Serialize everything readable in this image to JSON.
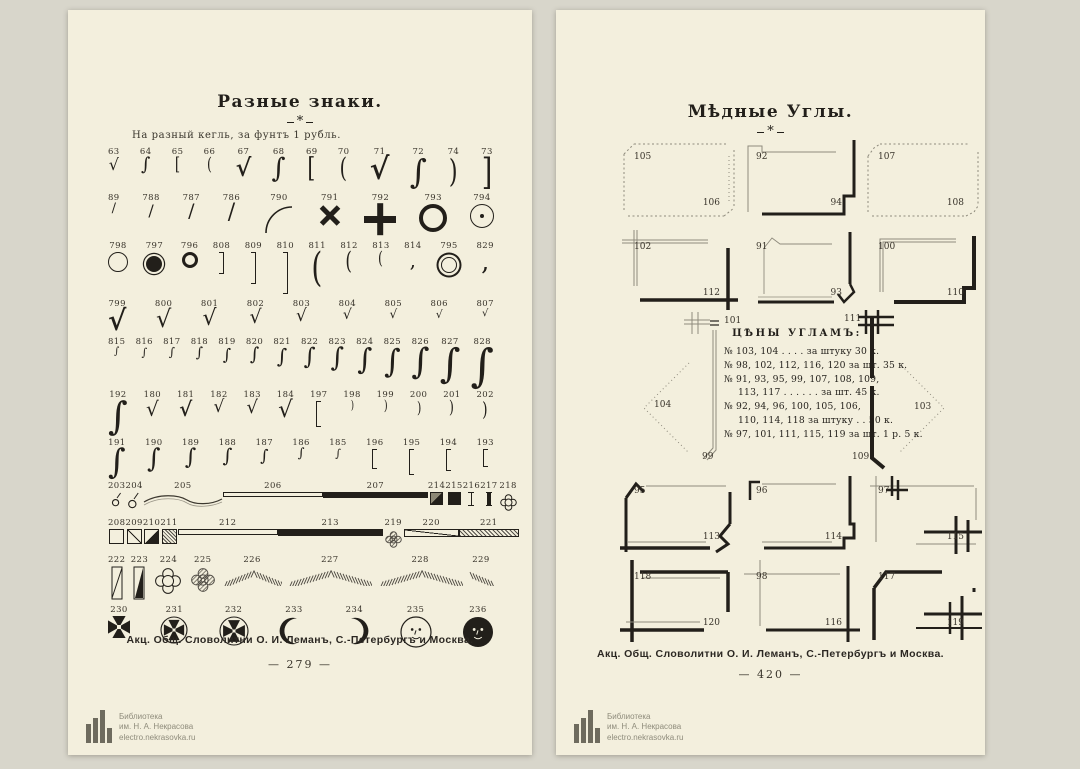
{
  "colors": {
    "backdrop": "#d8d6cb",
    "paper": "#f3efdd",
    "ink": "#221f1a",
    "gray_line": "#9b9789",
    "number": "#39342b"
  },
  "watermark": {
    "library": "Библиотека",
    "name": "им. Н. А. Некрасова",
    "url": "electro.nekrasovka.ru"
  },
  "left_page": {
    "title": "Разные знаки.",
    "ornament": "*",
    "subtitle": "На разный кегль, за фунтъ 1 рубль.",
    "caption": "Акц. Общ. Словолитни О. И. Леманъ, С.-Петербургъ и Москва.",
    "page_number": "— 279 —",
    "rows": [
      {
        "items": [
          {
            "n": "63",
            "g": "rad",
            "s": 16
          },
          {
            "n": "64",
            "g": "int",
            "s": 18
          },
          {
            "n": "65",
            "g": "bro",
            "s": 18
          },
          {
            "n": "66",
            "g": "pao",
            "s": 18
          },
          {
            "n": "67",
            "g": "rad",
            "s": 24,
            "b": 1
          },
          {
            "n": "68",
            "g": "int",
            "s": 27
          },
          {
            "n": "69",
            "g": "bro",
            "s": 27
          },
          {
            "n": "70",
            "g": "pao",
            "s": 27
          },
          {
            "n": "71",
            "g": "rad",
            "s": 30,
            "b": 1
          },
          {
            "n": "72",
            "g": "int",
            "s": 33
          },
          {
            "n": "74",
            "g": "pac",
            "s": 32
          },
          {
            "n": "73",
            "g": "brc",
            "s": 36
          }
        ]
      },
      {
        "items": [
          {
            "n": "89",
            "g": "sl",
            "s": 13
          },
          {
            "n": "788",
            "g": "sl",
            "s": 16
          },
          {
            "n": "787",
            "g": "sl",
            "s": 19
          },
          {
            "n": "786",
            "g": "sl",
            "s": 22
          },
          {
            "n": "790",
            "g": "arc",
            "s": 32
          },
          {
            "n": "791",
            "g": "x",
            "s": 24
          },
          {
            "n": "792",
            "g": "plus",
            "s": 32
          },
          {
            "n": "793",
            "g": "ring",
            "d": 28,
            "bw": 4
          },
          {
            "n": "794",
            "g": "ringdot",
            "d": 24
          }
        ]
      },
      {
        "items": [
          {
            "n": "798",
            "g": "ring",
            "d": 20,
            "bw": 1.2
          },
          {
            "n": "797",
            "g": "ringfill",
            "d": 16
          },
          {
            "n": "796",
            "g": "ring",
            "d": 16,
            "bw": 3.5
          },
          {
            "n": "808",
            "g": "brR",
            "h": 22
          },
          {
            "n": "809",
            "g": "brR",
            "h": 32
          },
          {
            "n": "810",
            "g": "brR",
            "h": 42
          },
          {
            "n": "811",
            "g": "pao",
            "s": 40
          },
          {
            "n": "812",
            "g": "pao",
            "s": 24
          },
          {
            "n": "813",
            "g": "pao",
            "s": 18
          },
          {
            "n": "814",
            "g": "comma",
            "s": 20
          },
          {
            "n": "795",
            "g": "dring",
            "d": 16
          },
          {
            "n": "829",
            "g": "comma",
            "s": 26
          }
        ]
      },
      {
        "items": [
          {
            "n": "799",
            "g": "chk",
            "s": 28,
            "b": 1
          },
          {
            "n": "800",
            "g": "chk",
            "s": 24
          },
          {
            "n": "801",
            "g": "chk",
            "s": 22
          },
          {
            "n": "802",
            "g": "chk",
            "s": 19
          },
          {
            "n": "803",
            "g": "chk",
            "s": 17
          },
          {
            "n": "804",
            "g": "chk",
            "s": 14
          },
          {
            "n": "805",
            "g": "chk",
            "s": 12
          },
          {
            "n": "806",
            "g": "chk",
            "s": 11
          },
          {
            "n": "807",
            "g": "chk",
            "s": 10
          }
        ]
      },
      {
        "items": [
          {
            "n": "815",
            "g": "sw",
            "s": 10
          },
          {
            "n": "816",
            "g": "sw",
            "s": 11
          },
          {
            "n": "817",
            "g": "sw",
            "s": 12
          },
          {
            "n": "818",
            "g": "sw",
            "s": 14
          },
          {
            "n": "819",
            "g": "sw",
            "s": 16
          },
          {
            "n": "820",
            "g": "sw",
            "s": 18
          },
          {
            "n": "821",
            "g": "sw",
            "s": 20
          },
          {
            "n": "822",
            "g": "sw",
            "s": 23
          },
          {
            "n": "823",
            "g": "sw",
            "s": 26
          },
          {
            "n": "824",
            "g": "sw",
            "s": 29
          },
          {
            "n": "825",
            "g": "sw",
            "s": 32
          },
          {
            "n": "826",
            "g": "sw",
            "s": 35
          },
          {
            "n": "827",
            "g": "sw",
            "s": 40
          },
          {
            "n": "828",
            "g": "sw",
            "s": 45
          }
        ]
      },
      {
        "items": [
          {
            "n": "192",
            "g": "sw",
            "s": 38
          },
          {
            "n": "180",
            "g": "chk",
            "s": 20
          },
          {
            "n": "181",
            "g": "chk",
            "s": 20,
            "b": 1
          },
          {
            "n": "182",
            "g": "chk",
            "s": 17
          },
          {
            "n": "183",
            "g": "chk",
            "s": 18
          },
          {
            "n": "184",
            "g": "chk",
            "s": 23
          },
          {
            "n": "197",
            "g": "brL",
            "h": 26
          },
          {
            "n": "198",
            "g": "pac",
            "s": 12
          },
          {
            "n": "199",
            "g": "pac",
            "s": 14
          },
          {
            "n": "200",
            "g": "pac",
            "s": 16
          },
          {
            "n": "201",
            "g": "pac",
            "s": 18
          },
          {
            "n": "202",
            "g": "pac",
            "s": 20
          }
        ]
      },
      {
        "items": [
          {
            "n": "191",
            "g": "sw",
            "s": 34
          },
          {
            "n": "190",
            "g": "sw",
            "s": 26
          },
          {
            "n": "189",
            "g": "sw",
            "s": 22
          },
          {
            "n": "188",
            "g": "sw",
            "s": 19
          },
          {
            "n": "187",
            "g": "sw",
            "s": 16
          },
          {
            "n": "186",
            "g": "sw",
            "s": 13
          },
          {
            "n": "185",
            "g": "sw",
            "s": 11
          },
          {
            "n": "196",
            "g": "brL",
            "h": 20
          },
          {
            "n": "195",
            "g": "brL",
            "h": 26
          },
          {
            "n": "194",
            "g": "brL",
            "h": 22
          },
          {
            "n": "193",
            "g": "brL",
            "h": 18
          }
        ]
      },
      {
        "items": [
          {
            "n": "203",
            "g": "ringstem",
            "s": 12
          },
          {
            "n": "204",
            "g": "ringstem",
            "s": 14
          },
          {
            "n": "205",
            "g": "wave",
            "w": 80
          },
          {
            "n": "206",
            "g": "barO",
            "w": 100,
            "h": 5
          },
          {
            "n": "207",
            "g": "barS",
            "w": 105,
            "h": 6
          },
          {
            "n": "214",
            "g": "sqHalf",
            "s": 13
          },
          {
            "n": "215",
            "g": "sqS",
            "s": 13
          },
          {
            "n": "216",
            "g": "tick"
          },
          {
            "n": "217",
            "g": "tick",
            "bold": 1
          },
          {
            "n": "218",
            "g": "clover",
            "s": 15,
            "v": "outline"
          }
        ]
      },
      {
        "items": [
          {
            "n": "208",
            "g": "sqO",
            "s": 15
          },
          {
            "n": "209",
            "g": "sqD",
            "s": 15
          },
          {
            "n": "210",
            "g": "sqT",
            "s": 15
          },
          {
            "n": "211",
            "g": "sqH",
            "s": 15
          },
          {
            "n": "212",
            "g": "barO",
            "w": 100,
            "h": 6
          },
          {
            "n": "213",
            "g": "barS",
            "w": 105,
            "h": 7
          },
          {
            "n": "219",
            "g": "clover",
            "s": 15,
            "v": "hatch"
          },
          {
            "n": "220",
            "g": "barD",
            "w": 55,
            "h": 8
          },
          {
            "n": "221",
            "g": "barH",
            "w": 60,
            "h": 8
          }
        ]
      },
      {
        "items": [
          {
            "n": "222",
            "g": "vrect",
            "v": "diag"
          },
          {
            "n": "223",
            "g": "vrect",
            "v": "half"
          },
          {
            "n": "224",
            "g": "clover",
            "s": 24,
            "v": "outline"
          },
          {
            "n": "225",
            "g": "clover",
            "s": 22,
            "v": "hatch"
          },
          {
            "n": "226",
            "g": "fan",
            "w": 60
          },
          {
            "n": "227",
            "g": "fan",
            "w": 85
          },
          {
            "n": "228",
            "g": "fan",
            "w": 85
          },
          {
            "n": "229",
            "g": "fan",
            "w": 26,
            "half": 1
          }
        ]
      },
      {
        "items": [
          {
            "n": "230",
            "g": "maltese",
            "s": 22
          },
          {
            "n": "231",
            "g": "crossC",
            "s": 28
          },
          {
            "n": "232",
            "g": "crossC",
            "s": 30
          },
          {
            "n": "233",
            "g": "cres",
            "s": 30
          },
          {
            "n": "234",
            "g": "cres",
            "s": 30,
            "fl": 1
          },
          {
            "n": "235",
            "g": "moonO",
            "s": 32
          },
          {
            "n": "236",
            "g": "moonB",
            "s": 32
          }
        ]
      }
    ]
  },
  "right_page": {
    "title": "Мѣдные Углы.",
    "ornament": "*",
    "caption": "Акц. Общ. Словолитни О. И. Леманъ, С.-Петербургъ и Москва.",
    "page_number": "— 420 —",
    "frame_rows": [
      [
        {
          "tl": "105",
          "br": "106",
          "style": "dotted"
        },
        {
          "tl": "92",
          "br": "94",
          "style": "thinthick"
        },
        {
          "tl": "107",
          "br": "108",
          "style": "dotted2"
        }
      ],
      [
        {
          "tl": "102",
          "br": "112",
          "style": "crossthin"
        },
        {
          "tl": "91",
          "br": "93",
          "style": "thinpeak"
        },
        {
          "tl": "100",
          "br": "110",
          "style": "doublethick"
        }
      ],
      [
        {
          "tl": "95",
          "br": "113",
          "style": "thicknotch"
        },
        {
          "tl": "96",
          "br": "114",
          "style": "thickstep"
        },
        {
          "tl": "97",
          "br": "115",
          "style": "hash"
        }
      ],
      [
        {
          "tl": "118",
          "br": "120",
          "style": "thickcross"
        },
        {
          "tl": "98",
          "br": "116",
          "style": "thincrossthick"
        },
        {
          "tl": "117",
          "br": "119",
          "style": "thickanglehash"
        }
      ]
    ],
    "price_box": {
      "title": "ЦѢНЫ УГЛАМЪ:",
      "lines": [
        "№ 103, 104 . . . .  за штуку 30 к.",
        "№ 98, 102, 112, 116, 120 за шт. 35 к.",
        "№ 91, 93, 95, 99, 107, 108, 109,",
        "113, 117 . . . . . .  за шт. 45 к.",
        "№ 92, 94, 96, 100, 105, 106,",
        "110, 114, 118 за штуку . .  50 к.",
        "№ 97, 101, 111, 115, 119 за шт. 1 р. 5 к."
      ],
      "corner_labels": {
        "top_left": "101",
        "top_right": "111",
        "bottom_left": "99",
        "bottom_right": "109",
        "left": "104",
        "right": "103"
      }
    }
  }
}
